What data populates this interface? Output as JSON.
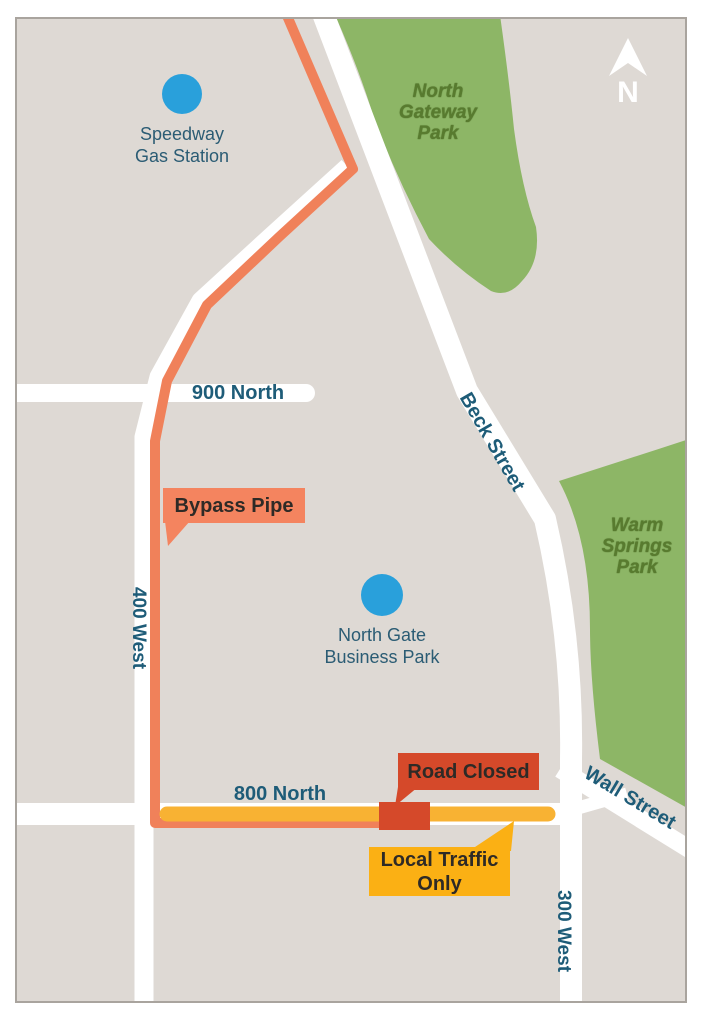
{
  "map": {
    "background": "#DED9D4",
    "border_color": "#A9A49E",
    "compass": {
      "label": "N"
    },
    "parks": {
      "north_gateway": {
        "name": "North\nGateway\nPark",
        "color": "#8DB666"
      },
      "warm_springs": {
        "name": "Warm\nSprings\nPark",
        "color": "#8DB666"
      }
    },
    "streets": {
      "n900": "900 North",
      "n800": "800 North",
      "w400": "400 West",
      "w300": "300 West",
      "beck": "Beck Street",
      "wall": "Wall Street"
    },
    "street_label_color": "#1E5C78",
    "pois": {
      "speedway": {
        "label": "Speedway\nGas Station",
        "marker_color": "#29A0DB"
      },
      "north_gate": {
        "label": "North Gate\nBusiness Park",
        "marker_color": "#29A0DB"
      }
    },
    "callouts": {
      "bypass_pipe": {
        "label": "Bypass Pipe",
        "color": "#F4845F"
      },
      "road_closed": {
        "label": "Road Closed",
        "color": "#D5492A"
      },
      "local_traffic": {
        "label": "Local Traffic\nOnly",
        "color": "#FBB014"
      }
    },
    "overlays": {
      "bypass_pipe_color": "#F0815A",
      "local_traffic_bar_color": "#F8B233",
      "road_closed_block_color": "#D5492A"
    }
  }
}
